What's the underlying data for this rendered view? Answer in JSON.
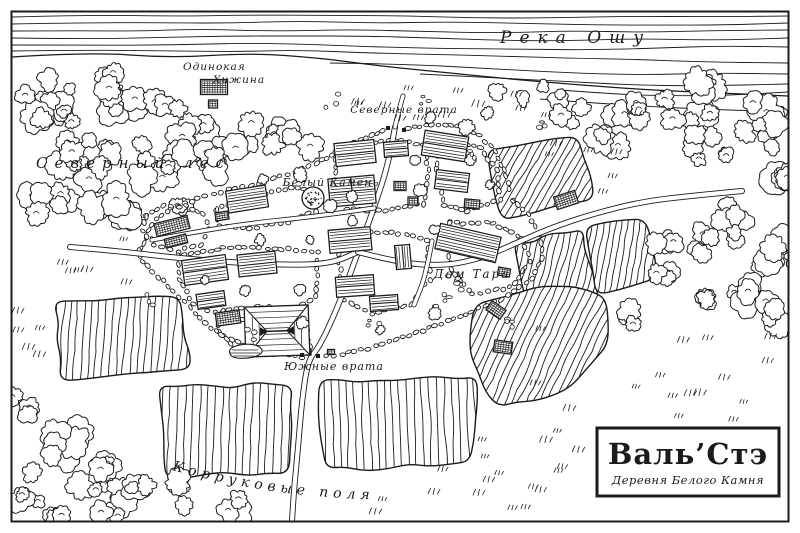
{
  "palette": {
    "ink": "#1b1b1b",
    "paper": "#ffffff"
  },
  "title_box": {
    "title": "Валь’Стэ",
    "subtitle": "Деревня Белого Камня"
  },
  "labels": {
    "river": "Река Ошу",
    "forest": "Северный лес",
    "hut_line1": "Одинокая",
    "hut_line2": "Хижина",
    "north_gate": "Северные врата",
    "white_stone": "Белый Камень",
    "tar_house": "Дом Тара",
    "south_gate": "Южные врата",
    "fields": "Корруковые поля"
  }
}
